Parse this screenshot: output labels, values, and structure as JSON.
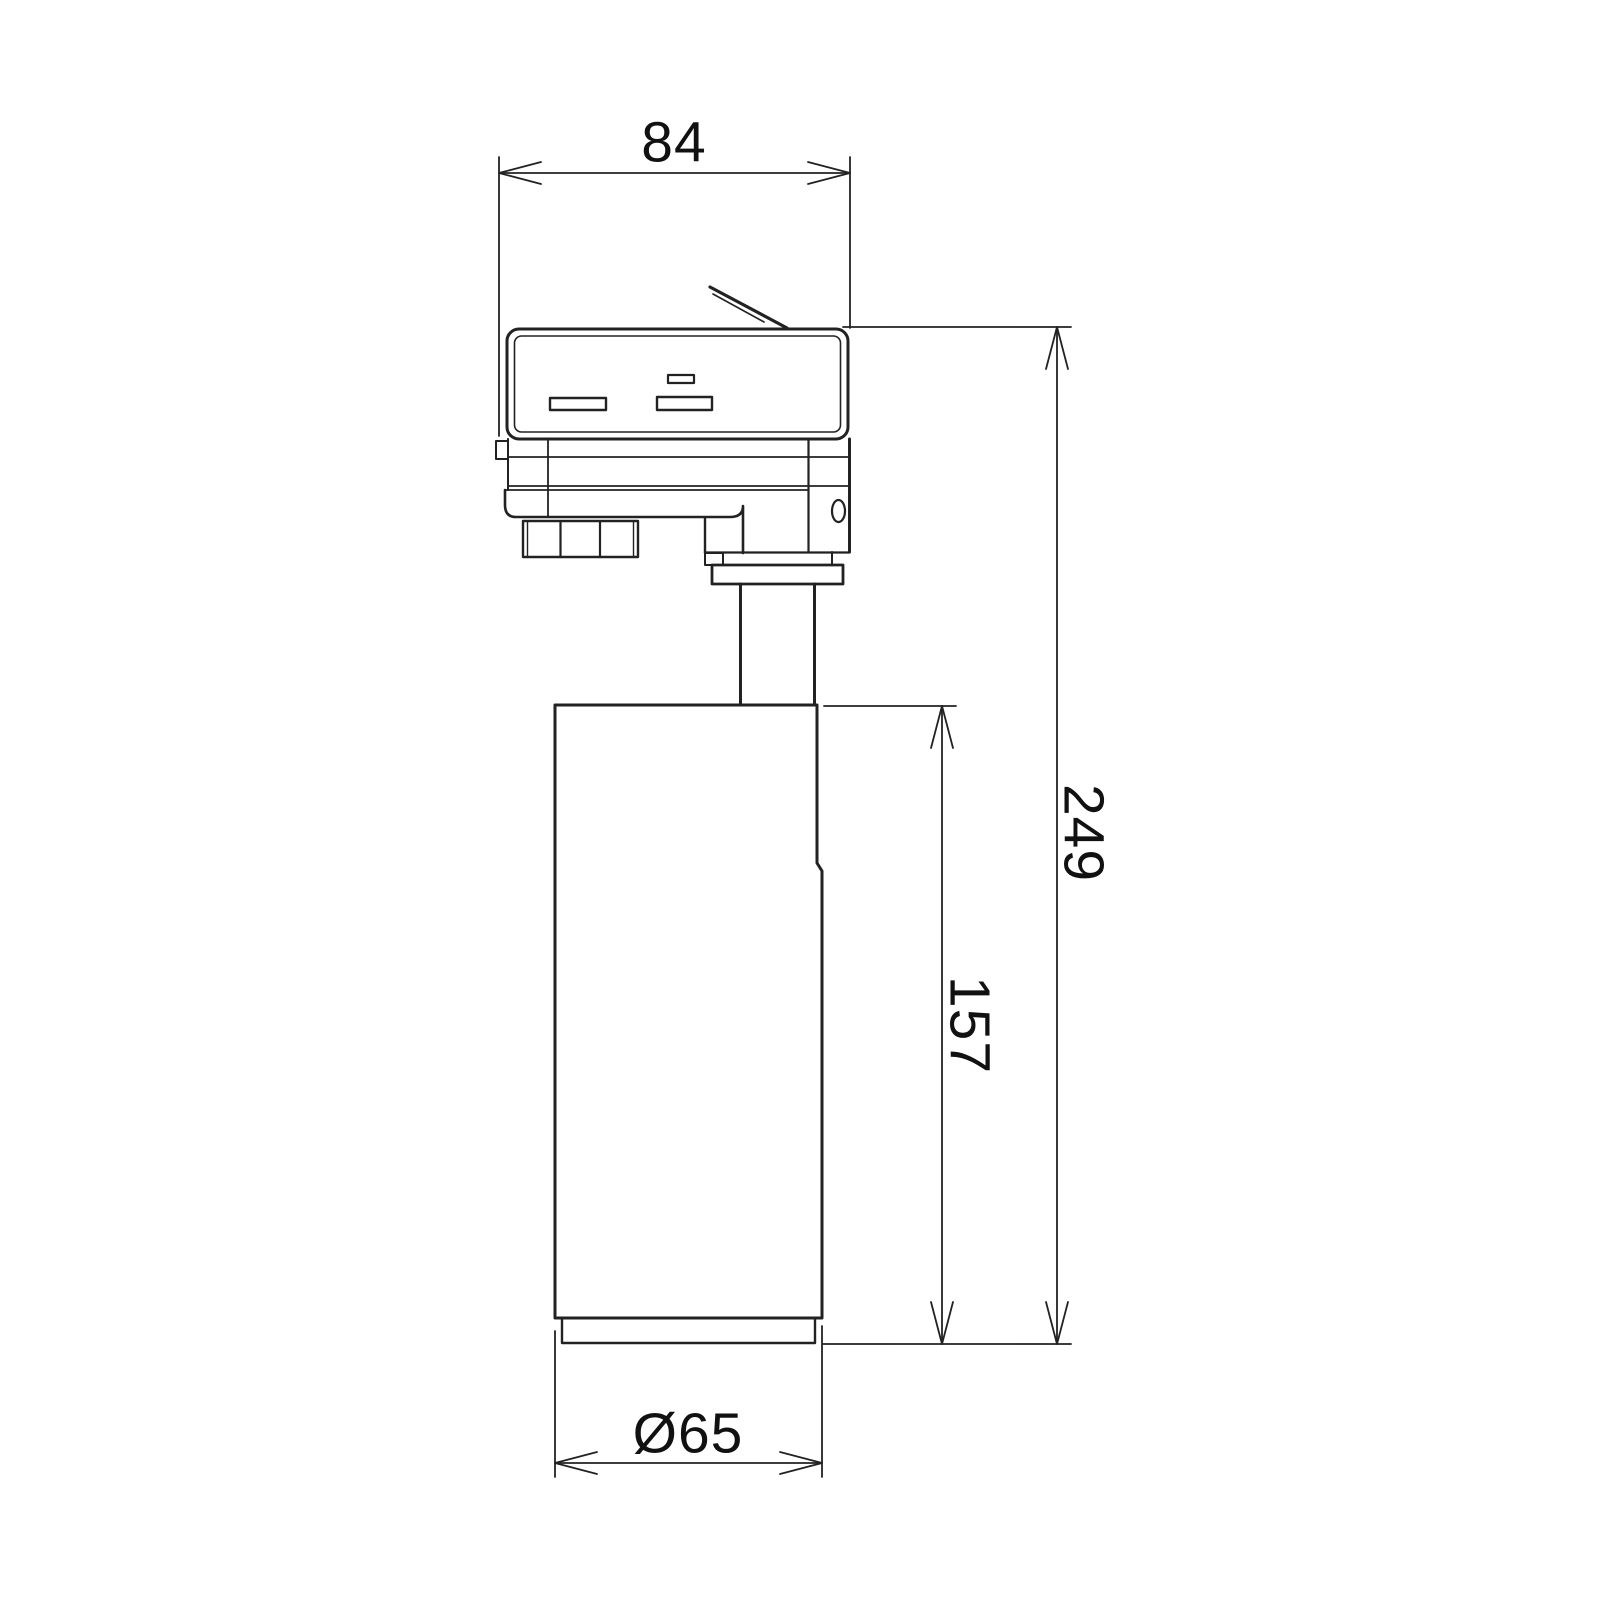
{
  "drawing": {
    "type": "technical-dimension-drawing",
    "subject": "track-mounted spotlight, side elevation",
    "line_color": "#222222",
    "background_color": "#ffffff",
    "dimension_labels": {
      "adapter_width": "84",
      "overall_height": "249",
      "body_height": "157",
      "body_diameter": "Ø65"
    }
  }
}
